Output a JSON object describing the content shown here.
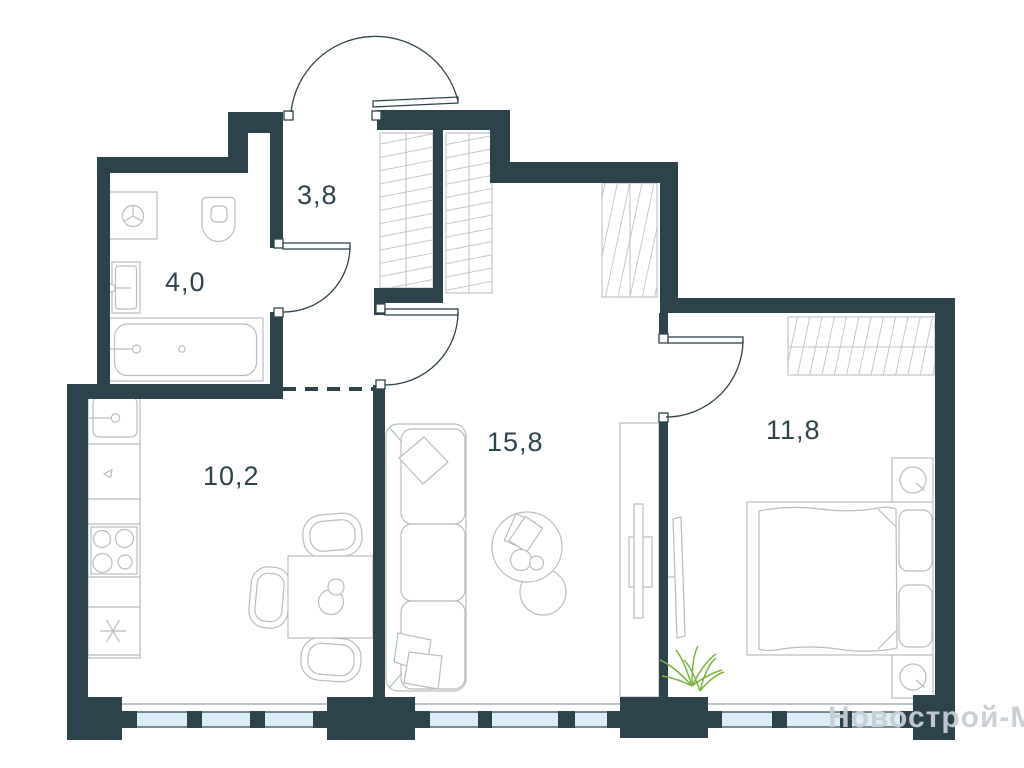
{
  "floor_plan": {
    "colors": {
      "wall": "#2d434b",
      "furniture_line": "#b7bdc2",
      "hatch_line": "#c3c8cd",
      "window_glass": "#d9eef8",
      "plant": "#7cb342",
      "room_label": "#2e444c",
      "watermark": "#c7ced4"
    },
    "room_labels": [
      {
        "room": "hallway",
        "text": "3,8"
      },
      {
        "room": "bathroom",
        "text": "4,0"
      },
      {
        "room": "kitchen",
        "text": "10,2"
      },
      {
        "room": "living-room",
        "text": "15,8"
      },
      {
        "room": "bedroom",
        "text": "11,8"
      }
    ],
    "watermark_text": "Новострой-М"
  }
}
